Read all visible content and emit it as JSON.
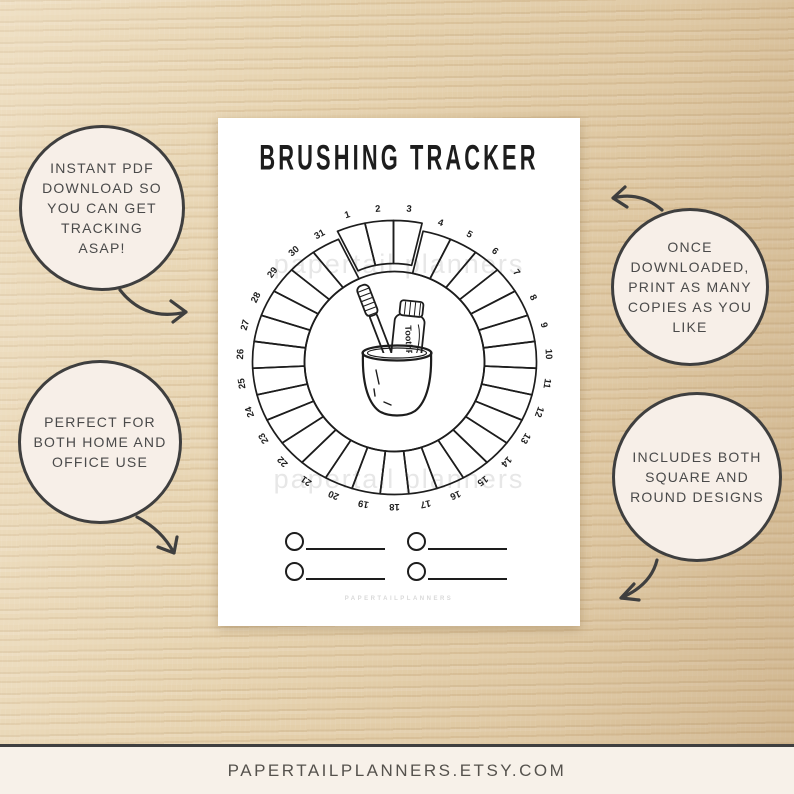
{
  "poster": {
    "title": "BRUSHING TRACKER",
    "watermark": "papertail planners",
    "brand_caption": "PAPERTAILPLANNERS",
    "toothpaste_label": "ToothPaste",
    "wheel_days": [
      1,
      2,
      3,
      4,
      5,
      6,
      7,
      8,
      9,
      10,
      11,
      12,
      13,
      14,
      15,
      16,
      17,
      18,
      19,
      20,
      21,
      22,
      23,
      24,
      25,
      26,
      27,
      28,
      29,
      30,
      31
    ],
    "checklist_slots": 4
  },
  "callouts": {
    "top_left": "INSTANT PDF\nDOWNLOAD SO\nYOU CAN GET\nTRACKING\nASAP!",
    "top_right": "ONCE\nDOWNLOADED,\nPRINT AS MANY\nCOPIES AS YOU\nLIKE",
    "bottom_left": "PERFECT FOR\nBOTH HOME AND\nOFFICE USE",
    "bottom_right": "INCLUDES BOTH\nSQUARE AND\nROUND DESIGNS"
  },
  "footer": {
    "url": "PAPERTAILPLANNERS.ETSY.COM"
  },
  "colors": {
    "ink": "#1d1d1d",
    "wood_base": "#e6d2ae",
    "bubble_fill": "#f7efe8",
    "bubble_border": "#3f3f3f",
    "bubble_text": "#4a4a4a",
    "watermark": "#e7e7e7",
    "footer_bg": "#f7f1e9",
    "footer_text": "#55524d"
  }
}
